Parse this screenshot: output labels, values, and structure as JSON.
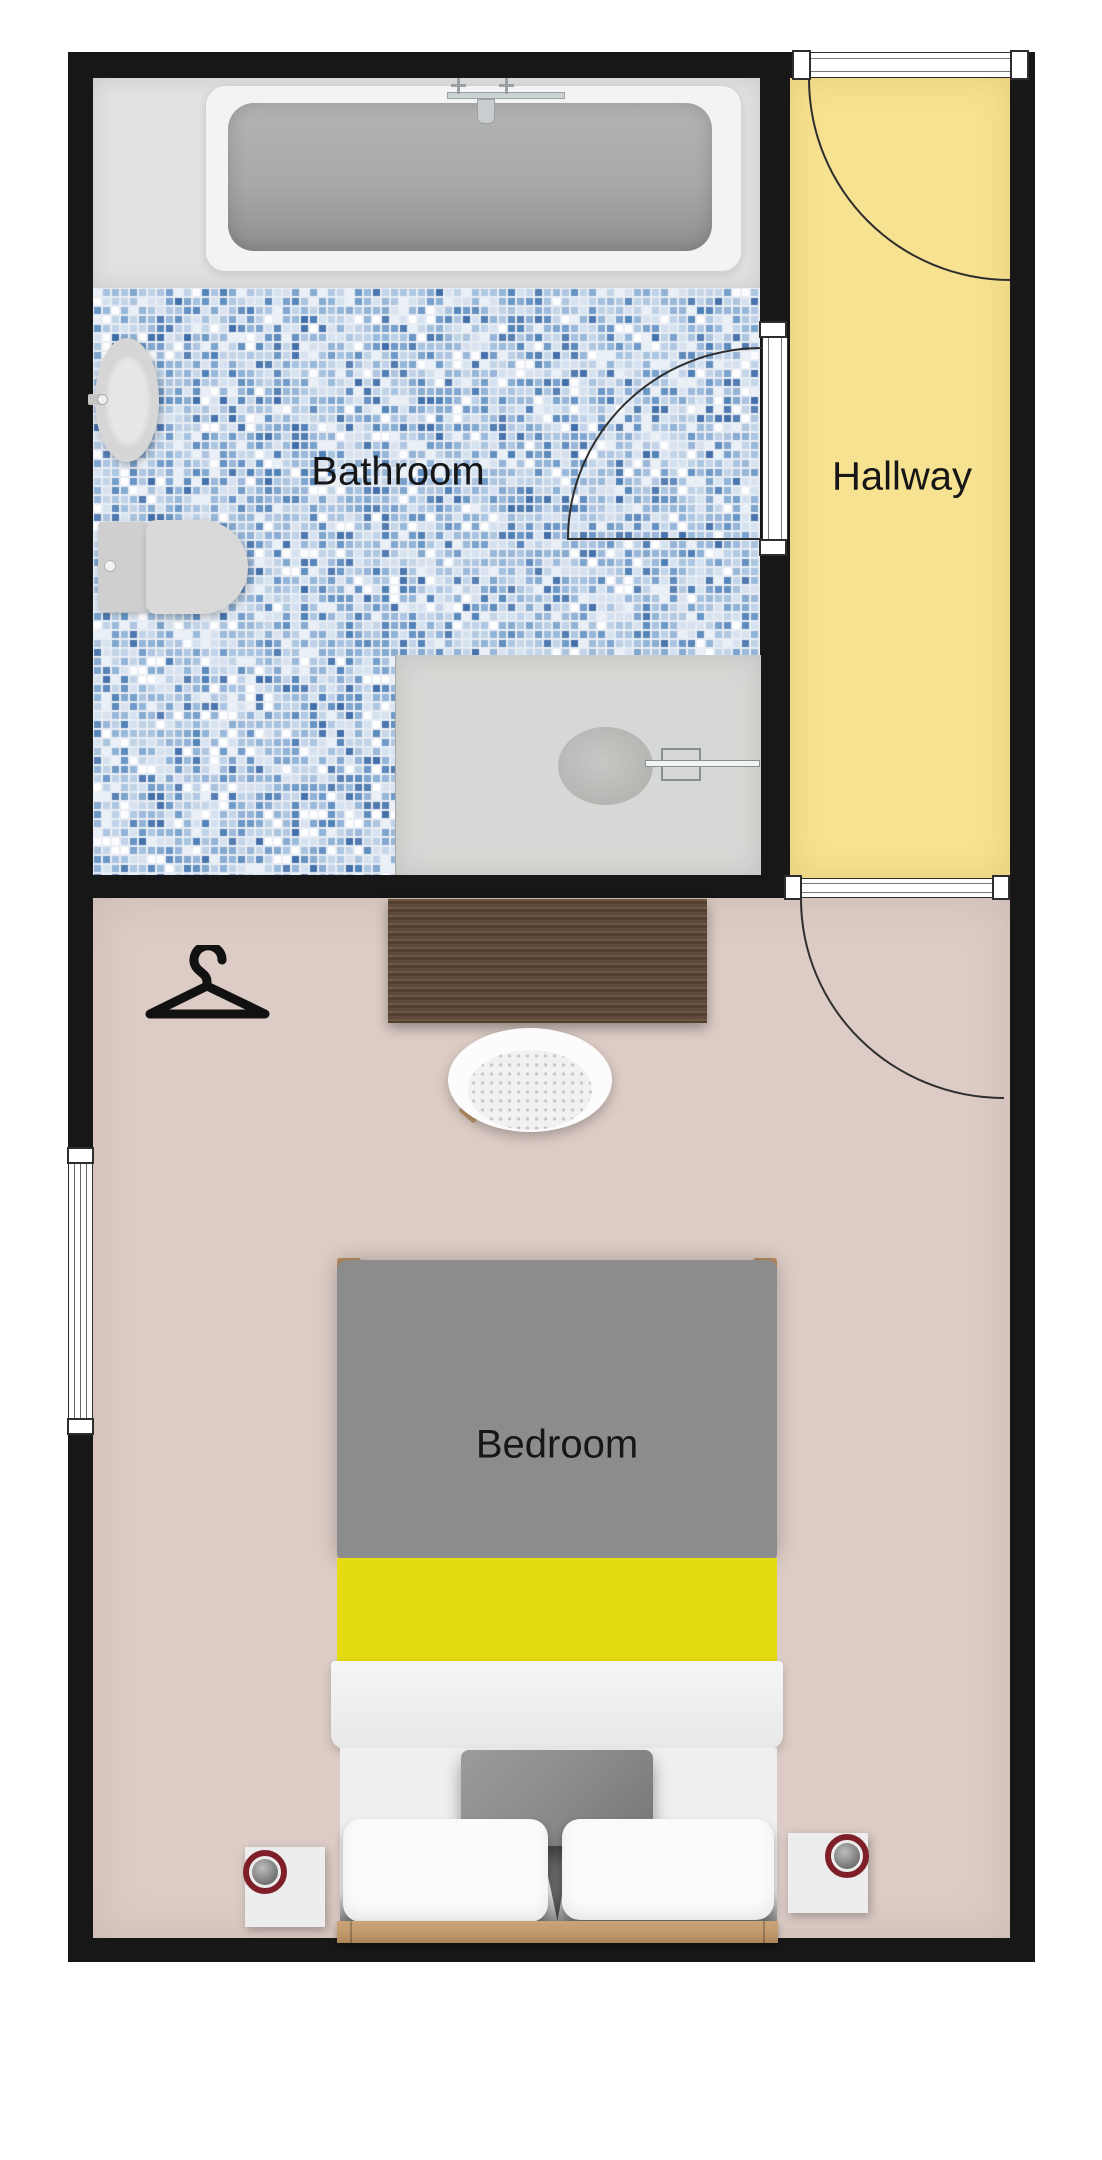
{
  "title": "Apartment floor plan",
  "rooms": {
    "bathroom": {
      "label": "Bathroom"
    },
    "hallway": {
      "label": "Hallway"
    },
    "bedroom": {
      "label": "Bedroom"
    }
  },
  "furniture": {
    "bathtub": "bathtub",
    "sink": "pedestal-sink",
    "toilet": "toilet",
    "shower": "shower-tray",
    "desk": "wooden-desk",
    "chair": "desk-chair",
    "hanger": "coat-hanger-icon",
    "bed": "double-bed",
    "nightstand_left": "nightstand",
    "nightstand_right": "nightstand",
    "lamp_left": "table-lamp",
    "lamp_right": "table-lamp"
  },
  "palette": {
    "wall": "#171717",
    "outside": "#ffffff",
    "bathroom_platform": "#e1e1e1",
    "tile_gap": "#e9edf4",
    "hallway_floor": "#f7e292",
    "bedroom_floor": "#ddccc6",
    "desk_wood_dark": "#54402f",
    "desk_wood_light": "#6e5845",
    "bed_duvet": "#8c8c8c",
    "bed_stripe": "#e4dc10",
    "bed_wood": "#c09a6c",
    "pillow_gray": "#8d8d8d",
    "lamp_ring": "#7e1f2a",
    "fixture_gray": "#d6d6d6",
    "shower_tray": "#d6d8d5",
    "door_line": "#2e2e2e",
    "tile_colors": [
      "#ffffff",
      "#eaf0f7",
      "#d6e1ef",
      "#c0d2e7",
      "#a9c2de",
      "#92b2d6",
      "#7aa2cc",
      "#6392c4",
      "#4d80b6",
      "#bcd0e6",
      "#a5c1de",
      "#8db1d6",
      "#d3e0ef",
      "#3f6da8"
    ]
  }
}
